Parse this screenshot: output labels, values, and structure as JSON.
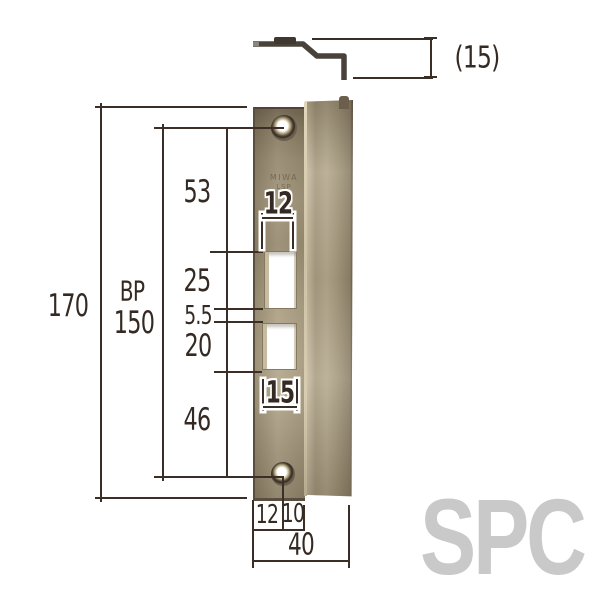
{
  "watermark": "SPC",
  "profile_view": {
    "lip_depth": "(15)"
  },
  "front_view": {
    "engraving": {
      "line1": "MIWA",
      "line2": "LSP"
    },
    "dims": {
      "overall_height": "170",
      "backset_label": "BP",
      "backset_value": "150",
      "seg_top_to_latch_hole": "53",
      "seg_latch_hole": "25",
      "seg_between_holes": "5.5",
      "seg_dead_hole": "20",
      "seg_dead_hole_to_screw": "46",
      "latch_hole_width": "12",
      "dead_hole_width": "15",
      "edge_to_screw_center": "12",
      "screw_center_to_fold": "10",
      "overall_width": "40"
    }
  },
  "colors": {
    "line": "#3b2e26",
    "plate_light": "#b6aa8f",
    "plate_dark": "#6e644f",
    "watermark_gray": "#c9c9c9"
  }
}
